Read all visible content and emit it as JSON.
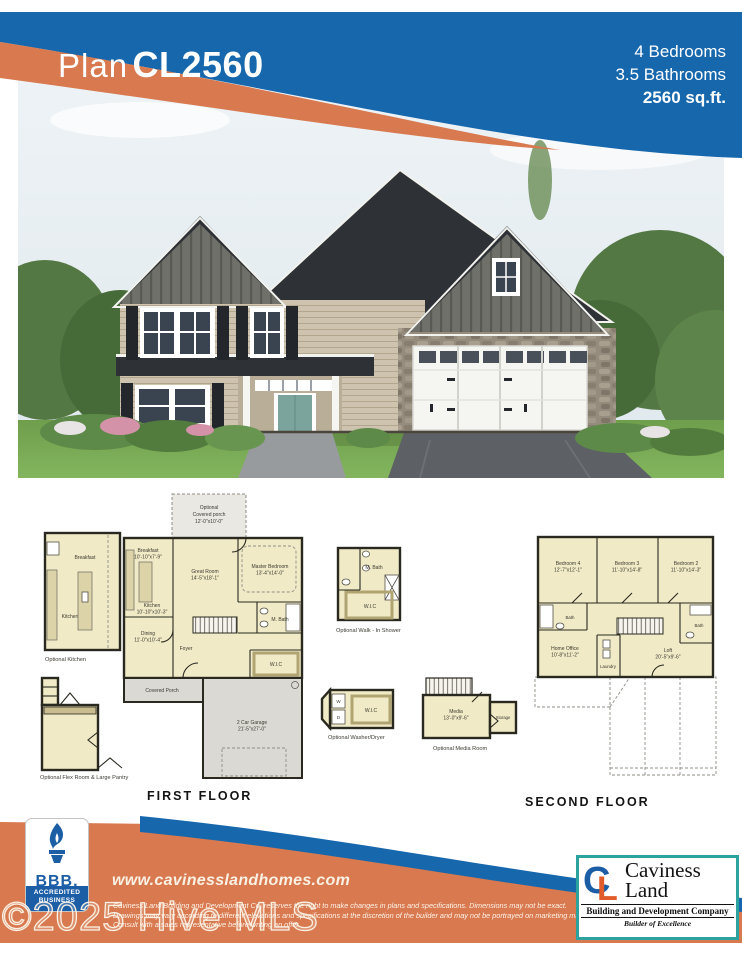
{
  "header": {
    "plan_word": "Plan",
    "plan_code": "CL2560",
    "bedrooms": "4  Bedrooms",
    "bathrooms": "3.5 Bathrooms",
    "sqft": "2560 sq.ft.",
    "blue": "#1767ad",
    "orange": "#d8794f"
  },
  "first_floor": {
    "title": "FIRST FLOOR",
    "optional_porch": {
      "l1": "Optional",
      "l2": "Covered porch",
      "l3": "12'-0\"x10'-0\""
    },
    "rooms": {
      "breakfast": {
        "name": "Breakfast",
        "dims": "10'-10\"x7'-9\""
      },
      "great_room": {
        "name": "Great Room",
        "dims": "14'-5\"x18'-1\""
      },
      "master": {
        "name": "Master Bedroom",
        "dims": "13'-4\"x14'-0\""
      },
      "kitchen": {
        "name": "Kitchen",
        "dims": "10'-10\"x10'-3\""
      },
      "mbath": {
        "name": "M. Bath"
      },
      "dining": {
        "name": "Dining",
        "dims": "11'-0\"x10'-4\""
      },
      "foyer": {
        "name": "Foyer"
      },
      "wic": {
        "name": "W.I.C"
      },
      "covered_porch": {
        "name": "Covered Porch"
      },
      "garage": {
        "name": "2 Car Garage",
        "dims": "21'-5\"x27'-0\""
      }
    },
    "insets": {
      "optional_kitchen": {
        "caption": "Optional Kitchen",
        "breakfast": "Breakfast",
        "kitchen": "Kitchen"
      },
      "optional_flex": {
        "caption": "Optional Flex Room & Large Pantry"
      }
    }
  },
  "options": {
    "walk_in_shower": {
      "caption": "Optional Walk - In Shower",
      "mbath": "M. Bath",
      "wic": "W.I.C"
    },
    "washer_dryer": {
      "caption": "Optional Washer/Dryer",
      "wic": "W.I.C",
      "washer": "W",
      "dryer": "D"
    },
    "media_room": {
      "caption": "Optional Media Room",
      "media": "Media",
      "media_dims": "13'-0\"x9'-6\"",
      "storage": "Storage"
    }
  },
  "second_floor": {
    "title": "SECOND  FLOOR",
    "rooms": {
      "bedroom4": {
        "name": "Bedroom 4",
        "dims": "12'-7\"x12'-1\""
      },
      "bedroom3": {
        "name": "Bedroom 3",
        "dims": "11'-10\"x14'-8\""
      },
      "bedroom2": {
        "name": "Bedroom 2",
        "dims": "11'-10\"x14'-3\""
      },
      "bath_left": {
        "name": "Bath"
      },
      "home_office": {
        "name": "Home Office",
        "dims": "10'-8\"x11'-2\""
      },
      "laundry": {
        "name": "Laundry"
      },
      "loft": {
        "name": "Loft",
        "dims": "20'-5\"x9'-6\""
      },
      "bath_right": {
        "name": "Bath"
      }
    }
  },
  "footer": {
    "website": "www.cavinesslandhomes.com",
    "disclaimer1": "Caviness Land Building and Development Co. reserves the right to make changes in plans and specifications. Dimensions may not be exact.",
    "disclaimer2": "Drawings may vary according to different elevations and specifications at the discretion of the builder and may not be portrayed on marketing materials.",
    "disclaimer3": "Consult with a sales representative before writing an offer.",
    "bbb": {
      "abbr": "BBB.",
      "accredited": "ACCREDITED",
      "business": "BUSINESS"
    },
    "caviness": {
      "c": "C",
      "l": "L",
      "name1": "Caviness",
      "name2": "Land",
      "sub": "Building and Development Company",
      "tagline": "Builder of Excellence"
    }
  },
  "watermark": {
    "text": "©2025 Hive MLS"
  },
  "colors": {
    "cream": "#f0eac6",
    "wall": "#29291f",
    "porch_gray": "#dbd9d3"
  }
}
